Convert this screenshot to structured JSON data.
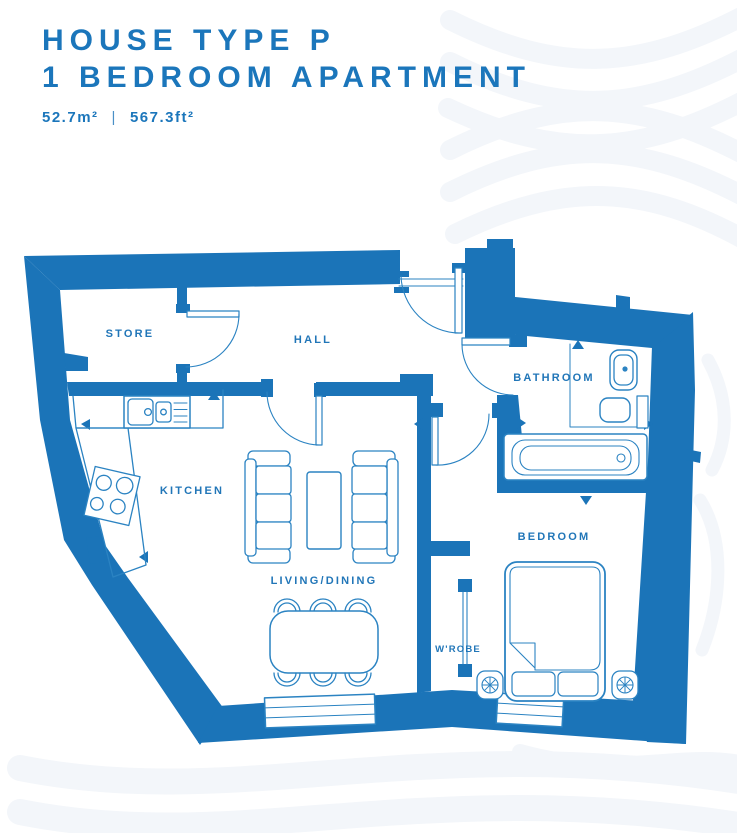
{
  "header": {
    "title_line1": "HOUSE TYPE P",
    "title_line2": "1 BEDROOM APARTMENT",
    "area_metric": "52.7m²",
    "area_separator": "|",
    "area_imperial": "567.3ft²"
  },
  "floor_plan": {
    "rooms": {
      "store": "STORE",
      "hall": "HALL",
      "kitchen": "KITCHEN",
      "living_dining": "LIVING/DINING",
      "bathroom": "BATHROOM",
      "bedroom": "BEDROOM",
      "wardrobe": "W'ROBE"
    },
    "colors": {
      "wall_blue": "#1b74b8",
      "line_blue": "#2b83c2",
      "label_blue": "#2176b8",
      "wave_gray": "#f3f6fa"
    }
  }
}
